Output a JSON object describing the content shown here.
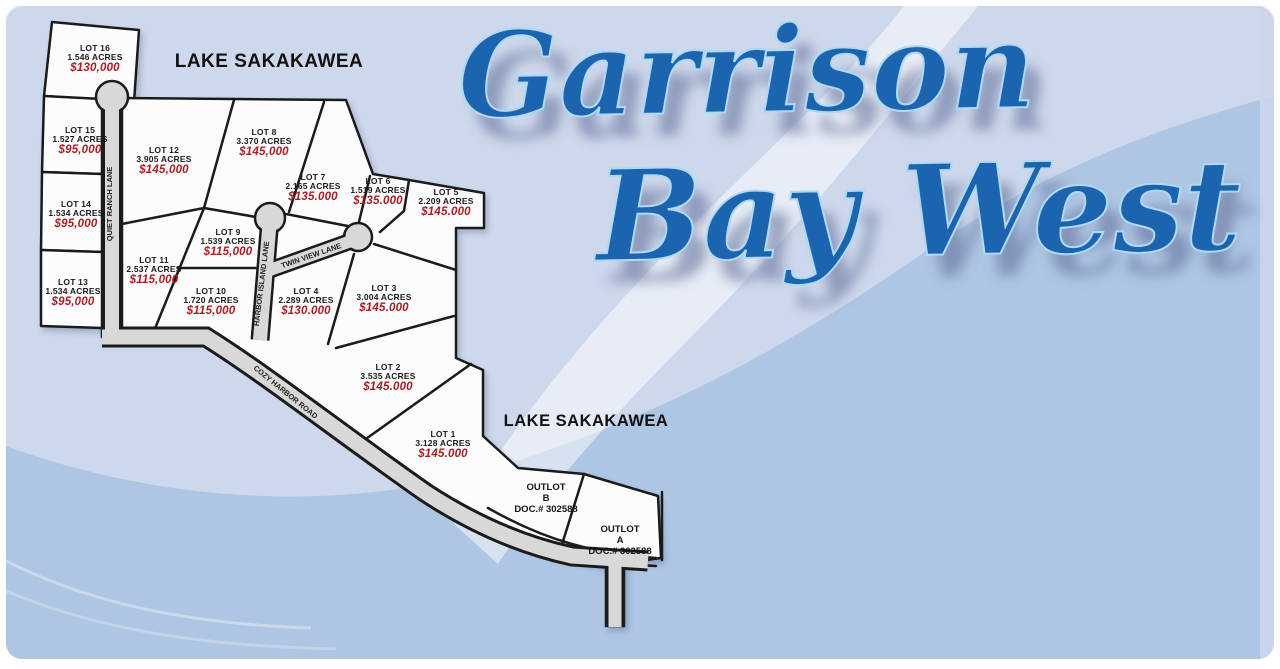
{
  "title": {
    "line1": "Garrison",
    "line2": "Bay West"
  },
  "lake_labels": [
    {
      "text": "LAKE SAKAKAWEA"
    },
    {
      "text": "LAKE SAKAKAWEA"
    }
  ],
  "roads": [
    {
      "name": "QUIET RANCH LANE"
    },
    {
      "name": "HARBOR ISLAND LANE"
    },
    {
      "name": "TWIN VIEW LANE"
    },
    {
      "name": "COZY HARBOR ROAD"
    }
  ],
  "lots": [
    {
      "name": "LOT 16",
      "acres": "1.546 ACRES",
      "price": "$130,000"
    },
    {
      "name": "LOT 15",
      "acres": "1.527 ACRES",
      "price": "$95,000"
    },
    {
      "name": "LOT 14",
      "acres": "1.534 ACRES",
      "price": "$95,000"
    },
    {
      "name": "LOT 13",
      "acres": "1.534 ACRES",
      "price": "$95,000"
    },
    {
      "name": "LOT 12",
      "acres": "3.905 ACRES",
      "price": "$145,000"
    },
    {
      "name": "LOT 11",
      "acres": "2.537 ACRES",
      "price": "$115,000"
    },
    {
      "name": "LOT 10",
      "acres": "1.720 ACRES",
      "price": "$115,000"
    },
    {
      "name": "LOT 9",
      "acres": "1.539 ACRES",
      "price": "$115,000"
    },
    {
      "name": "LOT 8",
      "acres": "3.370 ACRES",
      "price": "$145,000"
    },
    {
      "name": "LOT 7",
      "acres": "2.165 ACRES",
      "price": "$135.000"
    },
    {
      "name": "LOT 6",
      "acres": "1.519 ACRES",
      "price": "$135.000"
    },
    {
      "name": "LOT 5",
      "acres": "2.209 ACRES",
      "price": "$145.000"
    },
    {
      "name": "LOT 4",
      "acres": "2.289 ACRES",
      "price": "$130.000"
    },
    {
      "name": "LOT 3",
      "acres": "3.004 ACRES",
      "price": "$145.000"
    },
    {
      "name": "LOT 2",
      "acres": "3.535 ACRES",
      "price": "$145.000"
    },
    {
      "name": "LOT 1",
      "acres": "3.128 ACRES",
      "price": "$145.000"
    }
  ],
  "outlots": [
    {
      "name": "OUTLOT",
      "letter": "B",
      "doc": "DOC.# 302588"
    },
    {
      "name": "OUTLOT",
      "letter": "A",
      "doc": "DOC.# 302588"
    }
  ],
  "colors": {
    "background_light": "#ced8ec",
    "background_medium": "#aec5e3",
    "title_blue": "#1d64ae",
    "price_red": "#a81e24",
    "road_gray": "#d8d8d8",
    "parcel_white": "#fcfcfc"
  }
}
